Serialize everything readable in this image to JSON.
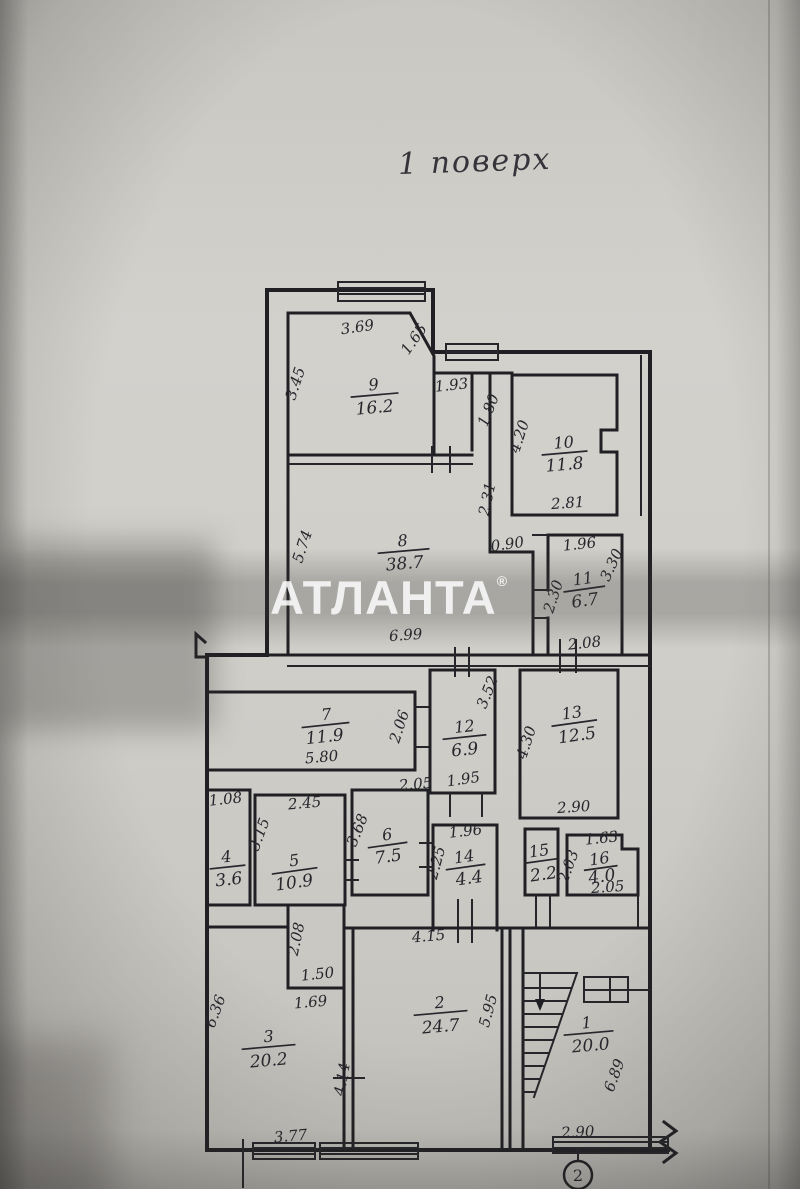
{
  "title": "1 поверх",
  "watermark": {
    "text": "АТЛАНТА",
    "mark": "®"
  },
  "sheet_number": "2",
  "rooms": {
    "r1": {
      "number": "1",
      "area": "20.0"
    },
    "r2": {
      "number": "2",
      "area": "24.7"
    },
    "r3": {
      "number": "3",
      "area": "20.2"
    },
    "r4": {
      "number": "4",
      "area": "3.6"
    },
    "r5": {
      "number": "5",
      "area": "10.9"
    },
    "r6": {
      "number": "6",
      "area": "7.5"
    },
    "r7": {
      "number": "7",
      "area": "11.9"
    },
    "r8": {
      "number": "8",
      "area": "38.7"
    },
    "r9": {
      "number": "9",
      "area": "16.2"
    },
    "r10": {
      "number": "10",
      "area": "11.8"
    },
    "r11": {
      "number": "11",
      "area": "6.7"
    },
    "r12": {
      "number": "12",
      "area": "6.9"
    },
    "r13": {
      "number": "13",
      "area": "12.5"
    },
    "r14": {
      "number": "14",
      "area": "4.4"
    },
    "r15": {
      "number": "15",
      "area": "2.2"
    },
    "r16": {
      "number": "16",
      "area": "4.0"
    }
  },
  "dims": {
    "room9_top": "3.69",
    "room9_left": "3.45",
    "room9_diag": "1.65",
    "hall_top": "1.93",
    "hall_right": "1.80",
    "room10_left": "4.20",
    "room10_bottom": "2.81",
    "room8_left": "5.74",
    "room8_bottom": "6.99",
    "room8_right_top": "2.31",
    "room8_jog": "0.90",
    "room11_top": "1.96",
    "room11_right": "3.30",
    "room11_bottom": "2.08",
    "room11_left": "2.30",
    "room7_bottom": "5.80",
    "room7_right": "2.06",
    "room12_right": "3.52",
    "room12_bottom": "1.95",
    "room13_left": "4.30",
    "room13_bottom": "2.90",
    "room4_top": "1.08",
    "room5_top": "2.45",
    "room5_left": "3.15",
    "room6_top": "2.05",
    "room6_left": "3.68",
    "room14_top": "1.96",
    "room14_left": "2.25",
    "room16_left": "2.03",
    "room16_top": "1.63",
    "room16_bottom": "2.05",
    "closet_left": "2.08",
    "closet_bottom": "1.50",
    "room3_inner": "1.69",
    "room3_left": "6.36",
    "room3_bottom": "3.77",
    "room3_right": "4.14",
    "room2_top": "4.15",
    "room2_right": "5.95",
    "room1_right": "6.89",
    "room1_bottom": "2.90"
  }
}
